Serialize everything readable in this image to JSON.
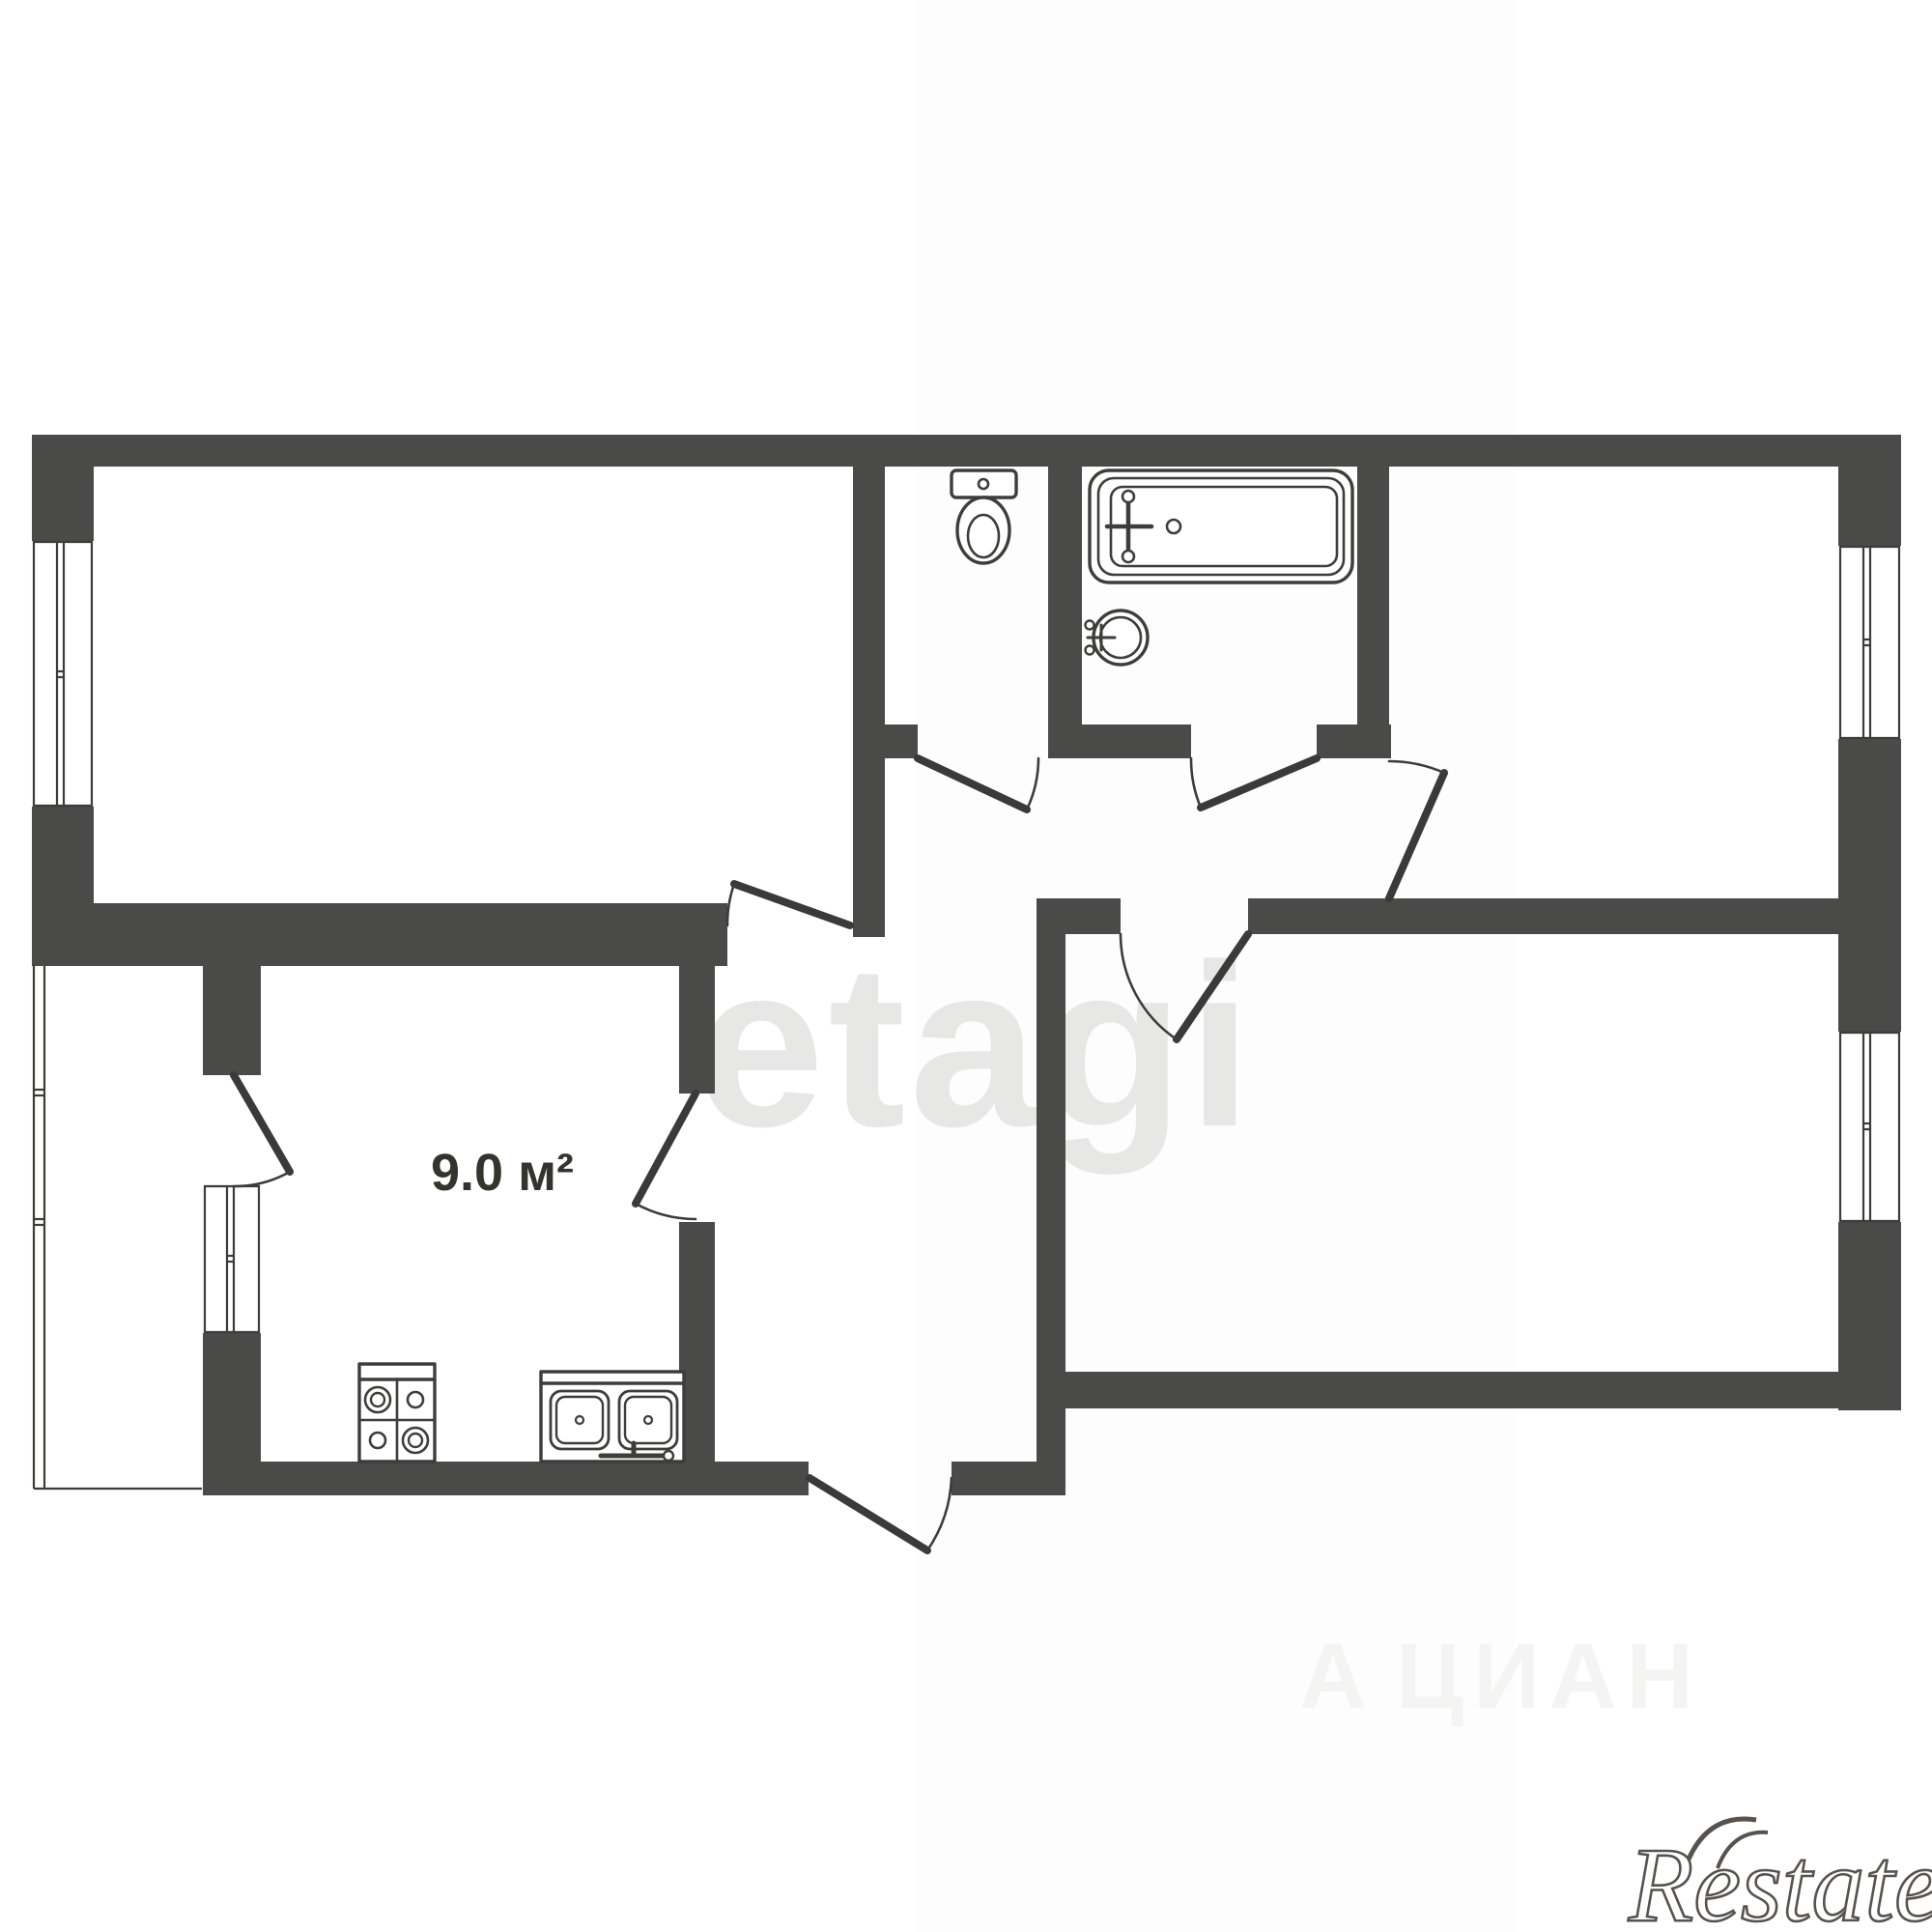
{
  "plan": {
    "type": "apartment-floor-plan",
    "rooms_visible": 5,
    "kitchen": {
      "area_label": "9.0 м²"
    },
    "fixtures": [
      "toilet",
      "bathtub",
      "wash-basin",
      "stove-4-burner",
      "double-kitchen-sink"
    ],
    "windows": 4,
    "balcony_strip": true
  },
  "watermarks": {
    "center": "etagi",
    "portal_mark": "А",
    "portal_text": "ЦИАН",
    "brand": "Restate"
  },
  "colors": {
    "wall": "#4a4a48",
    "outline": "#3c3c3a",
    "leaf": "#3a3a38",
    "watermark_center": "#e7e7e5",
    "watermark_portal": "#f4f4f2",
    "brand": "#57524d",
    "background": "#ffffff"
  }
}
